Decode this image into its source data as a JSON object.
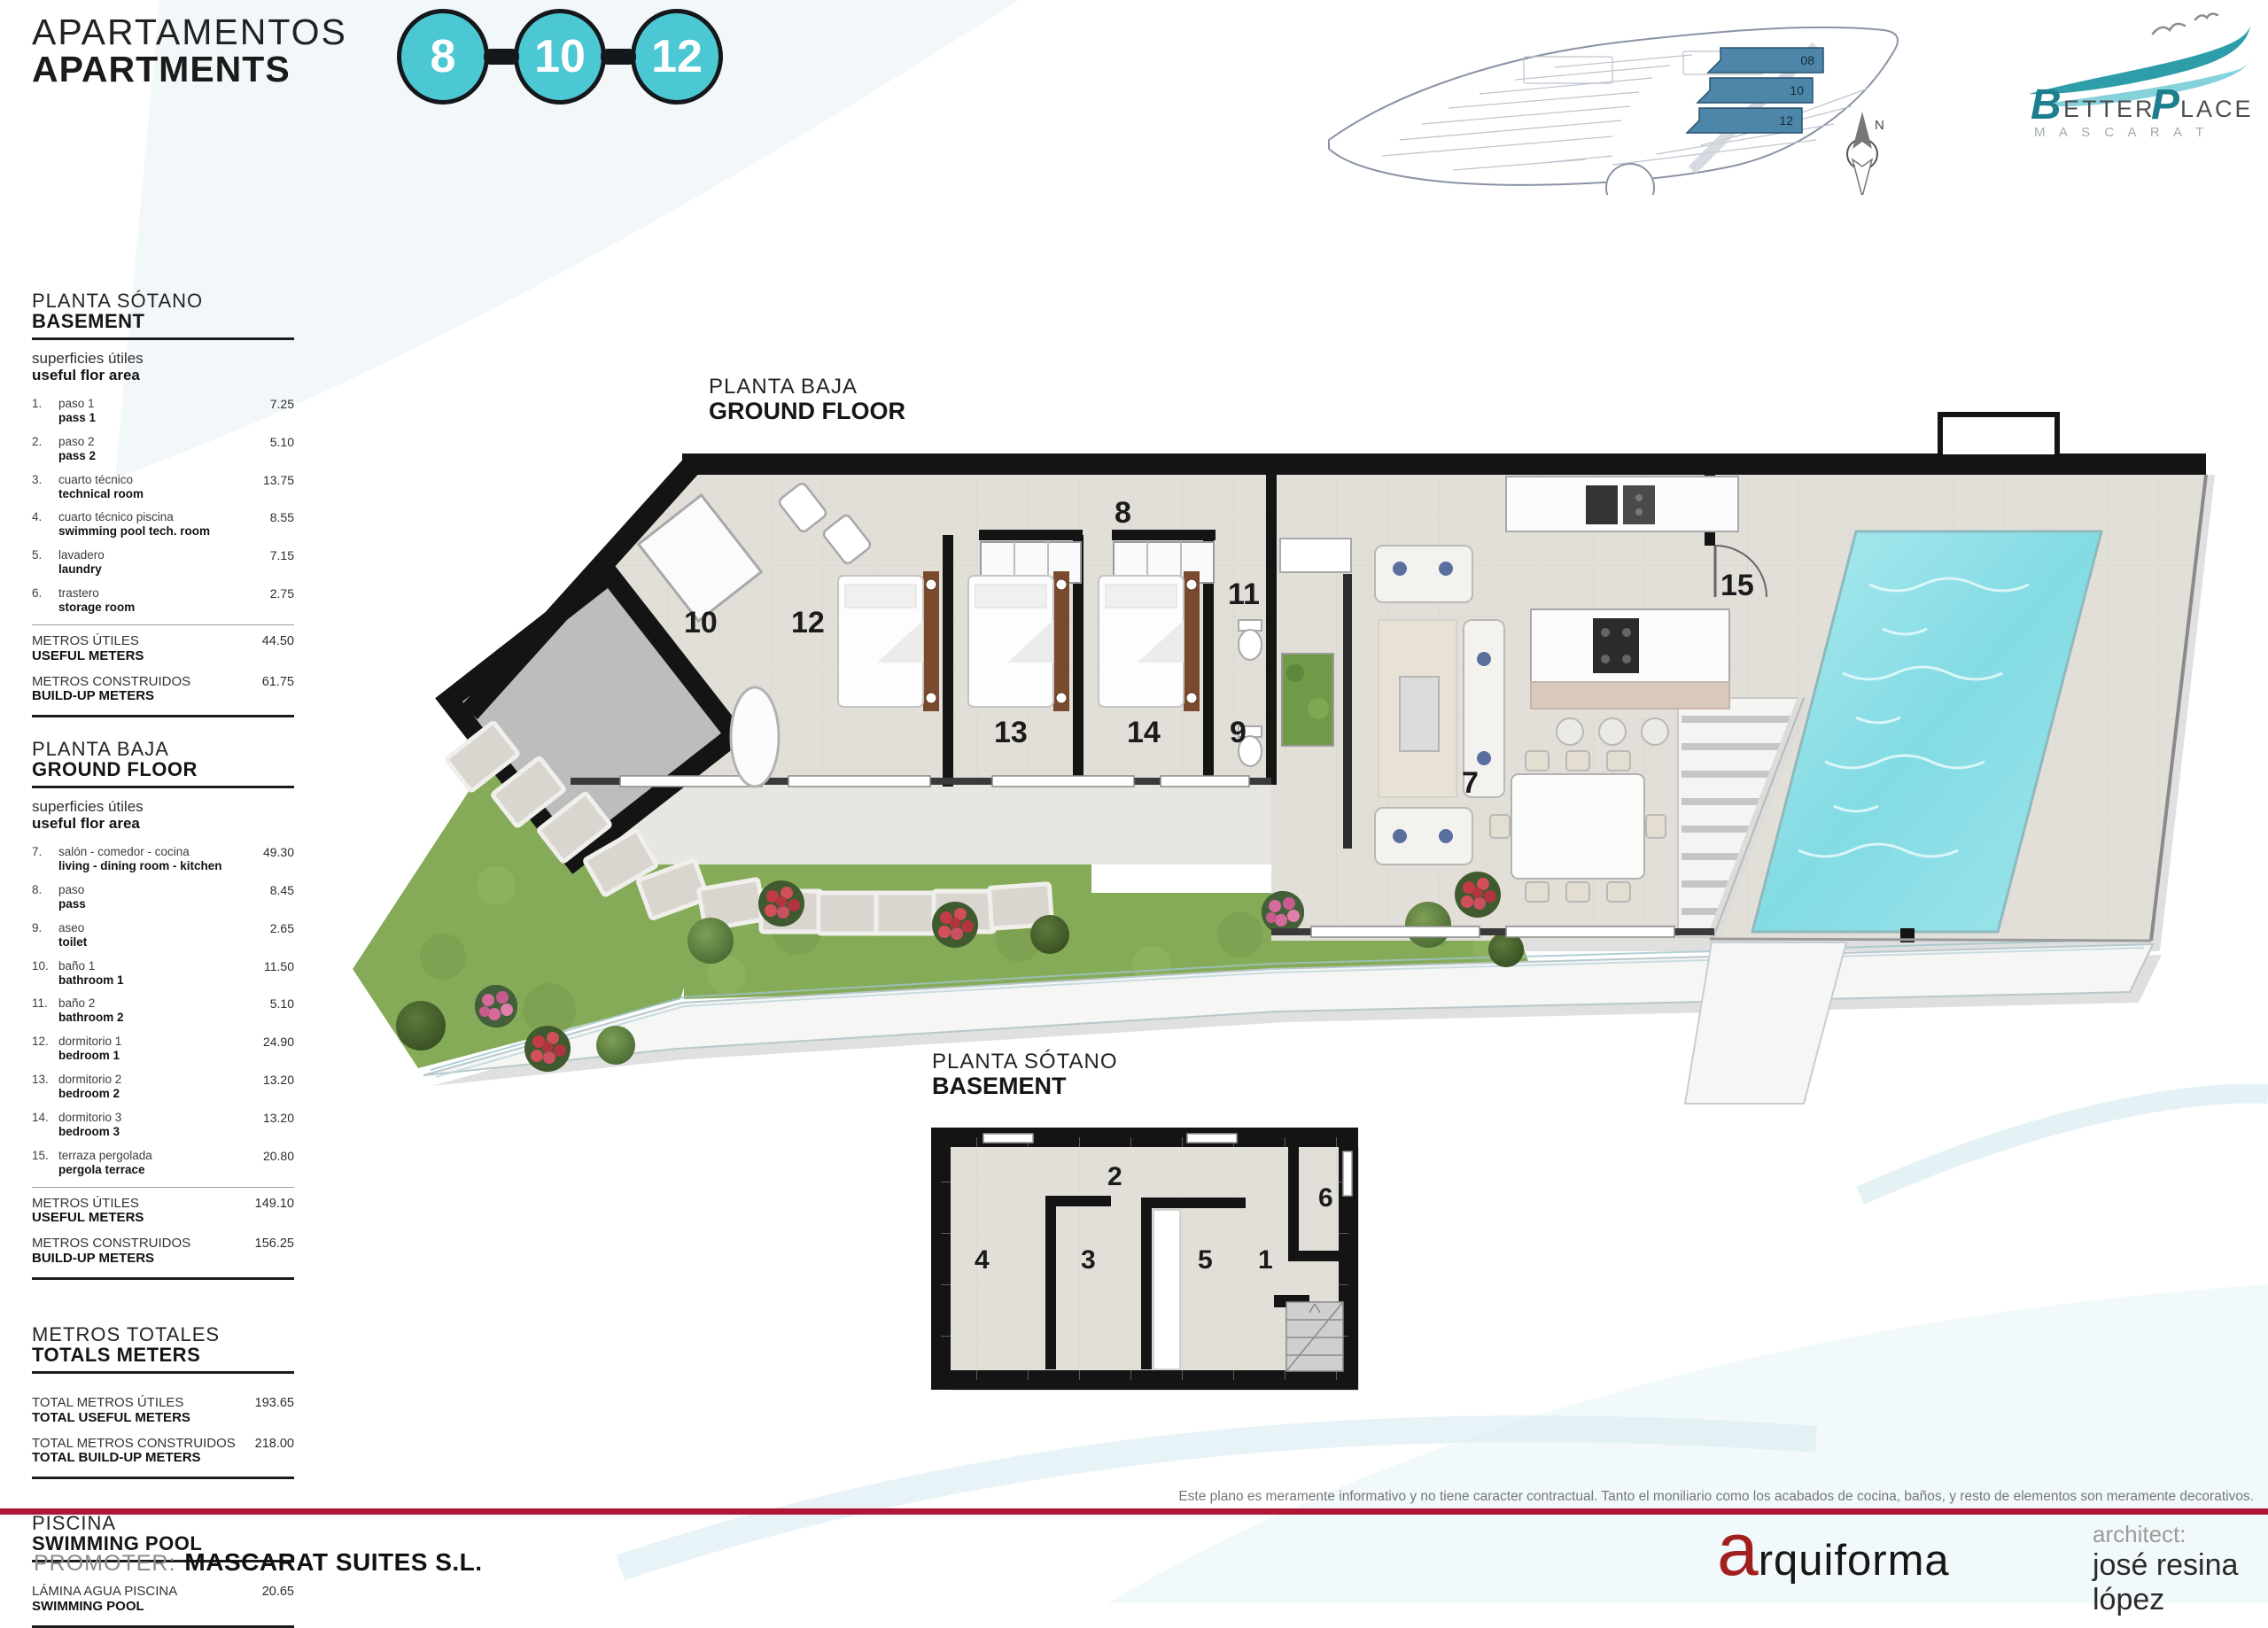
{
  "header": {
    "title_es": "APARTAMENTOS",
    "title_en": "APARTMENTS",
    "units": [
      "8",
      "10",
      "12"
    ]
  },
  "logo": {
    "b": "B",
    "etter": "ETTER",
    "p": "P",
    "lace": "LACE",
    "subtitle": "M A S C A R A T"
  },
  "site_plan": {
    "parcels": [
      "08",
      "10",
      "12"
    ],
    "north_label": "N"
  },
  "plans": {
    "ground": {
      "title_es": "PLANTA BAJA",
      "title_en": "GROUND FLOOR",
      "rooms": {
        "r7": "7",
        "r8": "8",
        "r9": "9",
        "r10": "10",
        "r11": "11",
        "r12": "12",
        "r13": "13",
        "r14": "14",
        "r15": "15"
      }
    },
    "basement": {
      "title_es": "PLANTA SÓTANO",
      "title_en": "BASEMENT",
      "rooms": {
        "r1": "1",
        "r2": "2",
        "r3": "3",
        "r4": "4",
        "r5": "5",
        "r6": "6"
      }
    }
  },
  "sidebar": {
    "sections": [
      {
        "title_es": "PLANTA SÓTANO",
        "title_en": "BASEMENT",
        "sub_es": "superficies útiles",
        "sub_en": "useful flor area",
        "rows": [
          {
            "num": "1.",
            "es": "paso 1",
            "en": "pass 1",
            "val": "7.25"
          },
          {
            "num": "2.",
            "es": "paso 2",
            "en": "pass 2",
            "val": "5.10"
          },
          {
            "num": "3.",
            "es": "cuarto técnico",
            "en": "technical room",
            "val": "13.75"
          },
          {
            "num": "4.",
            "es": "cuarto técnico piscina",
            "en": "swimming pool tech. room",
            "val": "8.55"
          },
          {
            "num": "5.",
            "es": "lavadero",
            "en": "laundry",
            "val": "7.15"
          },
          {
            "num": "6.",
            "es": "trastero",
            "en": "storage room",
            "val": "2.75"
          }
        ],
        "totals": [
          {
            "es": "METROS ÚTILES",
            "en": "USEFUL METERS",
            "val": "44.50"
          },
          {
            "es": "METROS CONSTRUIDOS",
            "en": "BUILD-UP METERS",
            "val": "61.75"
          }
        ]
      },
      {
        "title_es": "PLANTA BAJA",
        "title_en": "GROUND FLOOR",
        "sub_es": "superficies útiles",
        "sub_en": "useful flor area",
        "rows": [
          {
            "num": "7.",
            "es": "salón - comedor - cocina",
            "en": "living - dining room - kitchen",
            "val": "49.30"
          },
          {
            "num": "8.",
            "es": "paso",
            "en": "pass",
            "val": "8.45"
          },
          {
            "num": "9.",
            "es": "aseo",
            "en": "toilet",
            "val": "2.65"
          },
          {
            "num": "10.",
            "es": "baño 1",
            "en": "bathroom 1",
            "val": "11.50"
          },
          {
            "num": "11.",
            "es": "baño 2",
            "en": "bathroom 2",
            "val": "5.10"
          },
          {
            "num": "12.",
            "es": "dormitorio 1",
            "en": "bedroom 1",
            "val": "24.90"
          },
          {
            "num": "13.",
            "es": "dormitorio 2",
            "en": "bedroom 2",
            "val": "13.20"
          },
          {
            "num": "14.",
            "es": "dormitorio 3",
            "en": "bedroom 3",
            "val": "13.20"
          },
          {
            "num": "15.",
            "es": "terraza pergolada",
            "en": "pergola terrace",
            "val": "20.80"
          }
        ],
        "totals": [
          {
            "es": "METROS ÚTILES",
            "en": "USEFUL METERS",
            "val": "149.10"
          },
          {
            "es": "METROS CONSTRUIDOS",
            "en": "BUILD-UP METERS",
            "val": "156.25"
          }
        ]
      },
      {
        "title_es": "METROS TOTALES",
        "title_en": "TOTALS METERS",
        "rows": [],
        "totals": [
          {
            "es": "TOTAL METROS ÚTILES",
            "en": "TOTAL USEFUL METERS",
            "val": "193.65"
          },
          {
            "es": "TOTAL METROS CONSTRUIDOS",
            "en": "TOTAL BUILD-UP METERS",
            "val": "218.00"
          }
        ]
      },
      {
        "title_es": "PISCINA",
        "title_en": "SWIMMING POOL",
        "rows": [],
        "totals": [
          {
            "es": "LÁMINA AGUA PISCINA",
            "en": "SWIMMING POOL",
            "val": "20.65"
          }
        ]
      }
    ]
  },
  "footer": {
    "disclaimer": "Este plano es meramente informativo y no tiene caracter contractual. Tanto el moniliario como los acabados de cocina, baños, y resto de elementos son meramente decorativos.",
    "promoter_label": "PROMOTER:",
    "promoter_name": "MASCARAT SUITES S.L.",
    "studio_a": "a",
    "studio_rest": "rquiforma",
    "architect_label": "architect:",
    "architect_name": "josé resina lópez"
  }
}
